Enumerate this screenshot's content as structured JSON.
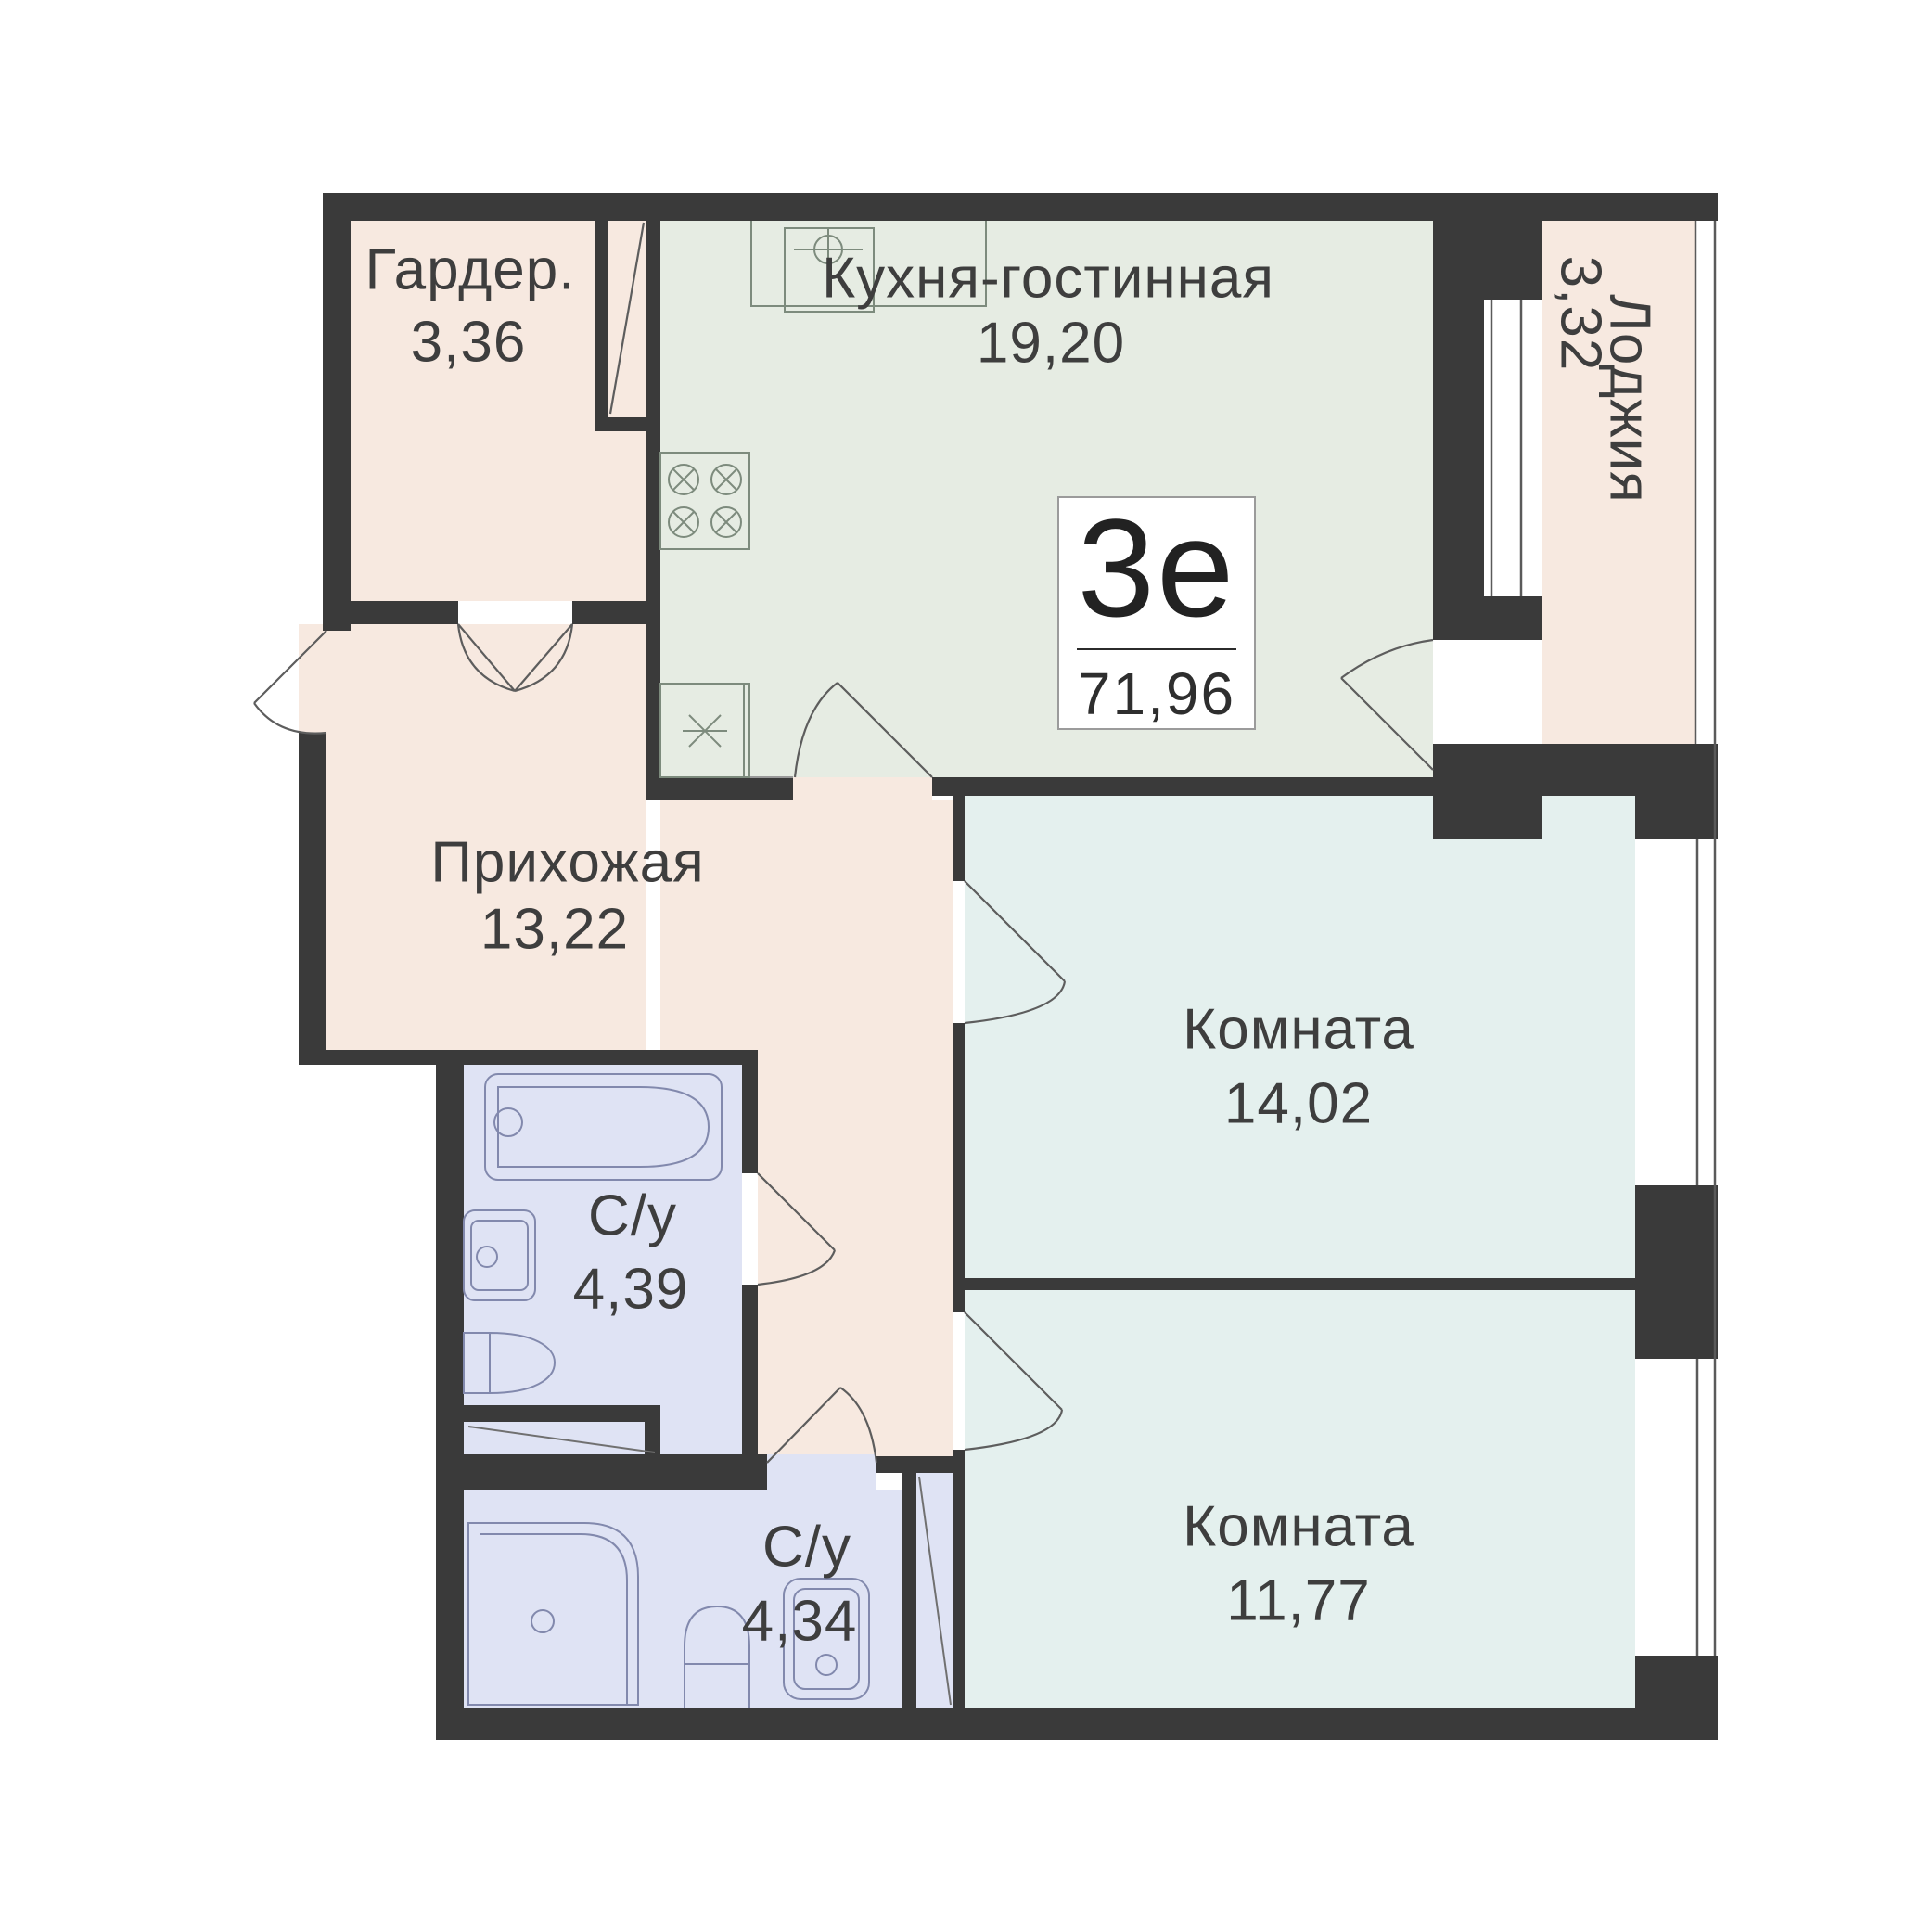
{
  "plan_title": "Apartment floor plan",
  "badge": {
    "type_label": "3е",
    "area_label": "71,96"
  },
  "rooms": [
    {
      "id": "wardrobe",
      "name": "Гардер.",
      "area": "3,36"
    },
    {
      "id": "kitchen-living",
      "name": "Кухня-гостинная",
      "area": "19,20"
    },
    {
      "id": "loggia",
      "name": "Лоджия",
      "area": "3,32"
    },
    {
      "id": "hallway",
      "name": "Прихожая",
      "area": "13,22"
    },
    {
      "id": "room-1",
      "name": "Комната",
      "area": "14,02"
    },
    {
      "id": "room-2",
      "name": "Комната",
      "area": "11,77"
    },
    {
      "id": "bathroom-1",
      "name": "С/у",
      "area": "4,39"
    },
    {
      "id": "bathroom-2",
      "name": "С/у",
      "area": "4,34"
    }
  ],
  "fixtures": [
    "bathtub-icon",
    "washbasin-icon",
    "toilet-icon",
    "shower-icon",
    "stove-burners-icon",
    "kitchen-sink-icon",
    "appliance-star-icon",
    "door-swing-icon",
    "window-glazing-icon"
  ],
  "colors": {
    "wall": "#3a3a3a",
    "beige": "#f7e9e0",
    "green": "#e6ece3",
    "cyan": "#e4f0ee",
    "lav": "#dfe3f4",
    "outline": "#5f5f5f",
    "fixb": "#8289ad",
    "fixk": "#7d8b7d",
    "text": "#3e3e3e",
    "badgeborder": "#9b9b9b",
    "badgetext": "#222222"
  }
}
